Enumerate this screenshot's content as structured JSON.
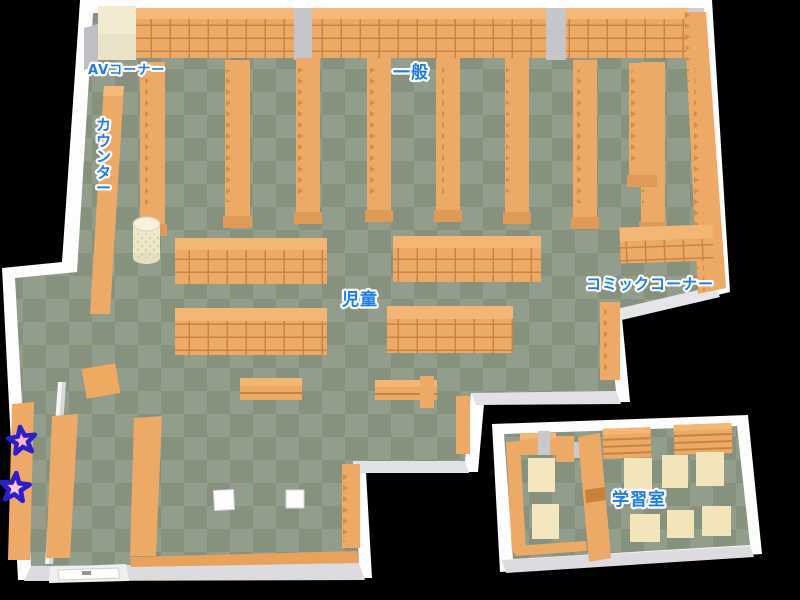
{
  "areas": {
    "av_corner": "AVコーナー",
    "general": "一般",
    "counter": "カウンター",
    "children": "児童",
    "comic_corner": "コミックコーナー",
    "study_room": "学習室"
  },
  "markers": {
    "stars": [
      {
        "label": "star-marker-1",
        "fill": "#ef6a7a",
        "outline": "#2a1ed2"
      },
      {
        "label": "star-marker-2",
        "fill": "#f79fb0",
        "outline": "#2a1ed2"
      }
    ]
  },
  "colors": {
    "label_text": "#1b7cf2",
    "label_outline": "#ffffff",
    "shelf_orange": "#eda966",
    "shelf_top": "#f3b675",
    "shelf_line": "#c98445",
    "floor_light": "#929d8b",
    "floor_dark": "#87927e",
    "wall_white": "#fdfdfd",
    "table_cream": "#f5e7bd",
    "background": "#000000"
  }
}
